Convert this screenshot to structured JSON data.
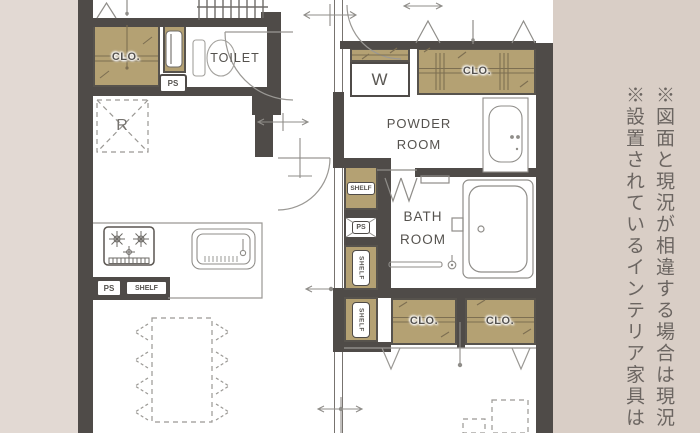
{
  "palette": {
    "wall": "#4f4b48",
    "closet_fill": "#b4a173",
    "closet_hatch": "#7d6f52",
    "floor": "#ffffff",
    "bg_left": "#e2d9d3",
    "bg_right": "#d9cec6",
    "line": "#8f8d89",
    "text": "#55524e",
    "note_text": "#6b6561"
  },
  "rooms": {
    "toilet": "TOILET",
    "powder_line1": "POWDER",
    "powder_line2": "ROOM",
    "bath_line1": "BATH",
    "bath_line2": "ROOM"
  },
  "fixtures": {
    "washer": "W",
    "fridge": "R"
  },
  "labels": {
    "closet": "CLO.",
    "pipe_space": "PS",
    "shelf": "SHELF"
  },
  "notes": {
    "line1": "※図面と現況が相違する場合は現況",
    "line2": "※設置されているインテリア家具は"
  }
}
